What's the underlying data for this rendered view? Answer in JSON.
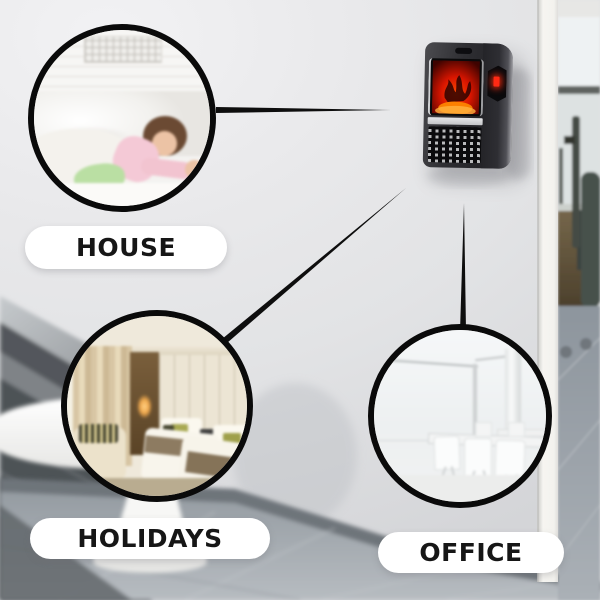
{
  "image": {
    "kind": "product-use-case-collage",
    "product": "wall-plug-flame-effect-mini-heater"
  },
  "callouts": [
    {
      "id": "house",
      "label": "HOUSE",
      "scene": "child-sleeping-in-white-bedroom"
    },
    {
      "id": "holidays",
      "label": "HOLIDAYS",
      "scene": "hotel-twin-bed-room"
    },
    {
      "id": "office",
      "label": "OFFICE",
      "scene": "bright-meeting-room-white-chairs"
    }
  ],
  "colors": {
    "circle_border": "#0a0a0a",
    "connector_line": "#0e0e0e",
    "pill_background": "#ffffff",
    "label_text": "#161616",
    "wall": "#e4e5e7",
    "heater_body": "#2e2e32",
    "flame_red": "#d81500",
    "led_red": "#ff2a14"
  }
}
